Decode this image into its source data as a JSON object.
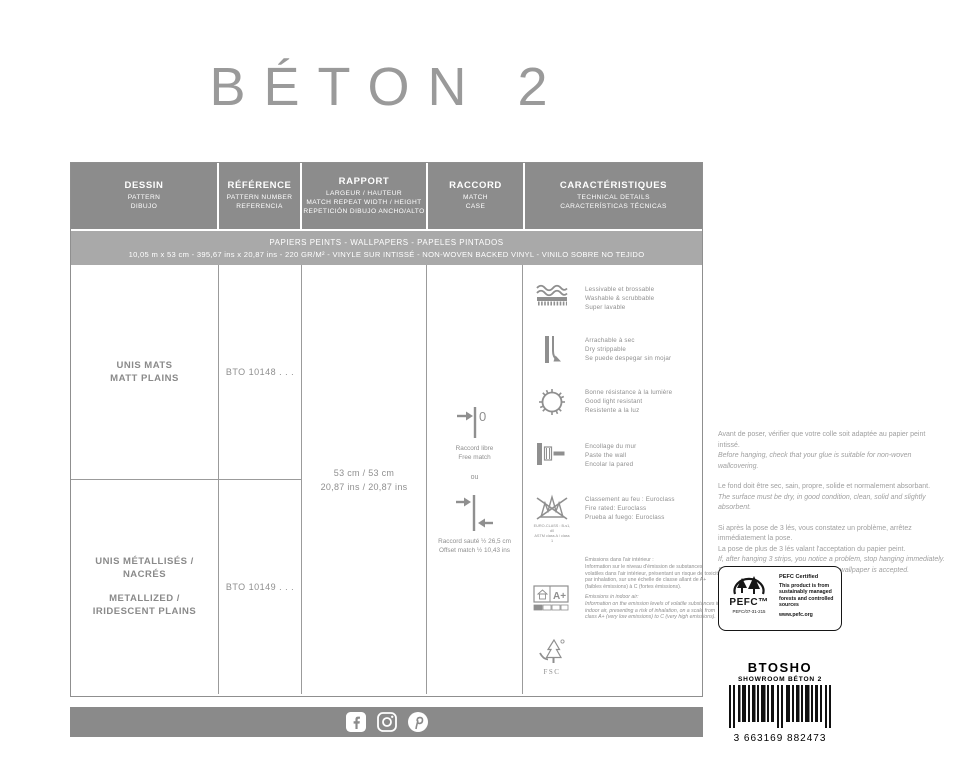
{
  "title": "BÉTON 2",
  "colors": {
    "header_gray": "#8c8c8c",
    "band_gray": "#a9a9a9",
    "footer_bar_gray": "#8a8a8a",
    "text_gray": "#8f8f8f",
    "title_gray": "#9a9a9a"
  },
  "table": {
    "headers": [
      {
        "title": "DESSIN",
        "sub1": "PATTERN",
        "sub2": "DIBUJO"
      },
      {
        "title": "RÉFÉRENCE",
        "sub1": "PATTERN NUMBER",
        "sub2": "REFERENCIA"
      },
      {
        "title": "RAPPORT",
        "sub1": "LARGEUR / HAUTEUR",
        "sub2": "MATCH REPEAT WIDTH / HEIGHT",
        "sub3": "REPETICIÓN DIBUJO ANCHO/ALTO"
      },
      {
        "title": "RACCORD",
        "sub1": "MATCH",
        "sub2": "CASE"
      },
      {
        "title": "CARACTÉRISTIQUES",
        "sub1": "TECHNICAL DETAILS",
        "sub2": "CARACTERÍSTICAS TÉCNICAS"
      }
    ],
    "band": {
      "line1": "PAPIERS PEINTS - WALLPAPERS - PAPELES PINTADOS",
      "line2": "10,05 m x 53 cm - 395,67 ins x 20,87 ins - 220 GR/M² - VINYLE SUR INTISSÉ - NON-WOVEN BACKED VINYL - VINILO SOBRE NO TEJIDO"
    },
    "rows": [
      {
        "name_fr": "UNIS MATS",
        "name_en": "MATT PLAINS",
        "reference": "BTO 10148 . . ."
      },
      {
        "name_fr": "UNIS MÉTALLISÉS / NACRÉS",
        "name_en": "METALLIZED / IRIDESCENT PLAINS",
        "reference": "BTO 10149 . . ."
      }
    ],
    "rapport": {
      "metric": "53 cm / 53 cm",
      "imperial": "20,87 ins / 20,87 ins"
    },
    "raccord": {
      "zero": "0",
      "free_fr": "Raccord libre",
      "free_en": "Free match",
      "or": "ou",
      "offset_fr": "Raccord sauté ½ 26,5 cm",
      "offset_en": "Offset match ½ 10,43 ins"
    },
    "characteristics": [
      {
        "icon": "washable-icon",
        "fr": "Lessivable et brossable",
        "en": "Washable & scrubbable",
        "es": "Super lavable"
      },
      {
        "icon": "dry-strippable-icon",
        "fr": "Arrachable à sec",
        "en": "Dry strippable",
        "es": "Se puede despegar sin mojar"
      },
      {
        "icon": "light-resistance-icon",
        "fr": "Bonne résistance à la lumière",
        "en": "Good light resistant",
        "es": "Resistente a la luz"
      },
      {
        "icon": "paste-the-wall-icon",
        "fr": "Encollage du mur",
        "en": "Paste the wall",
        "es": "Encolar la pared"
      },
      {
        "icon": "fire-rating-icon",
        "fr": "Classement au feu : Euroclass",
        "en": "Fire rated: Euroclass",
        "es": "Prueba al fuego: Euroclass",
        "caption1": "EURO-CLASS : B-s1, d0",
        "caption2": "ASTM class A / class 1"
      },
      {
        "icon": "emissions-icon",
        "label": "A+",
        "fr_title": "Émissions dans l'air intérieur :",
        "fr_body": "Information sur le niveau d'émission de substances volatiles dans l'air intérieur, présentant un risque de toxicité par inhalation, sur une échelle de classe allant de A+ (faibles émissions) à C (fortes émissions).",
        "en_title": "Emissions in indoor air:",
        "en_body": "Information on the emission levels of volatile substances in indoor air, presenting a risk of inhalation, on a scale from class A+ (very low emissions) to C (very high emissions)."
      },
      {
        "icon": "fsc-icon",
        "label": "FSC"
      }
    ]
  },
  "notes": {
    "p1_fr": "Avant de poser, vérifier que votre colle soit adaptée au papier peint intissé.",
    "p1_en": "Before hanging, check that your glue is suitable for non-woven wallcovering.",
    "p2_fr": "Le fond doit être sec, sain, propre, solide et normalement absorbant.",
    "p2_en": "The surface must be dry, in good condition, clean, solid and slightly absorbent.",
    "p3_fr1": "Si après la pose de 3 lés, vous constatez un problème, arrêtez immédiatement la pose.",
    "p3_fr2": "La pose de plus de 3 lés valant l'acceptation du papier peint.",
    "p3_en1": "If, after hanging 3 strips, you notice a problem, stop hanging immediately.",
    "p3_en2": "Successful hanging 3 strips means the wallpaper is accepted."
  },
  "pefc": {
    "logo": "PEFC™",
    "cert": "PEFC/07-31-215",
    "title": "PEFC Certified",
    "body": "This product is from sustainably managed forests and controlled sources",
    "url": "www.pefc.org"
  },
  "barcode": {
    "code": "BTOSHO",
    "label": "SHOWROOM BÉTON 2",
    "digits": "3 663169 882473"
  },
  "footer": {
    "icons": [
      "facebook",
      "instagram",
      "pinterest"
    ]
  }
}
